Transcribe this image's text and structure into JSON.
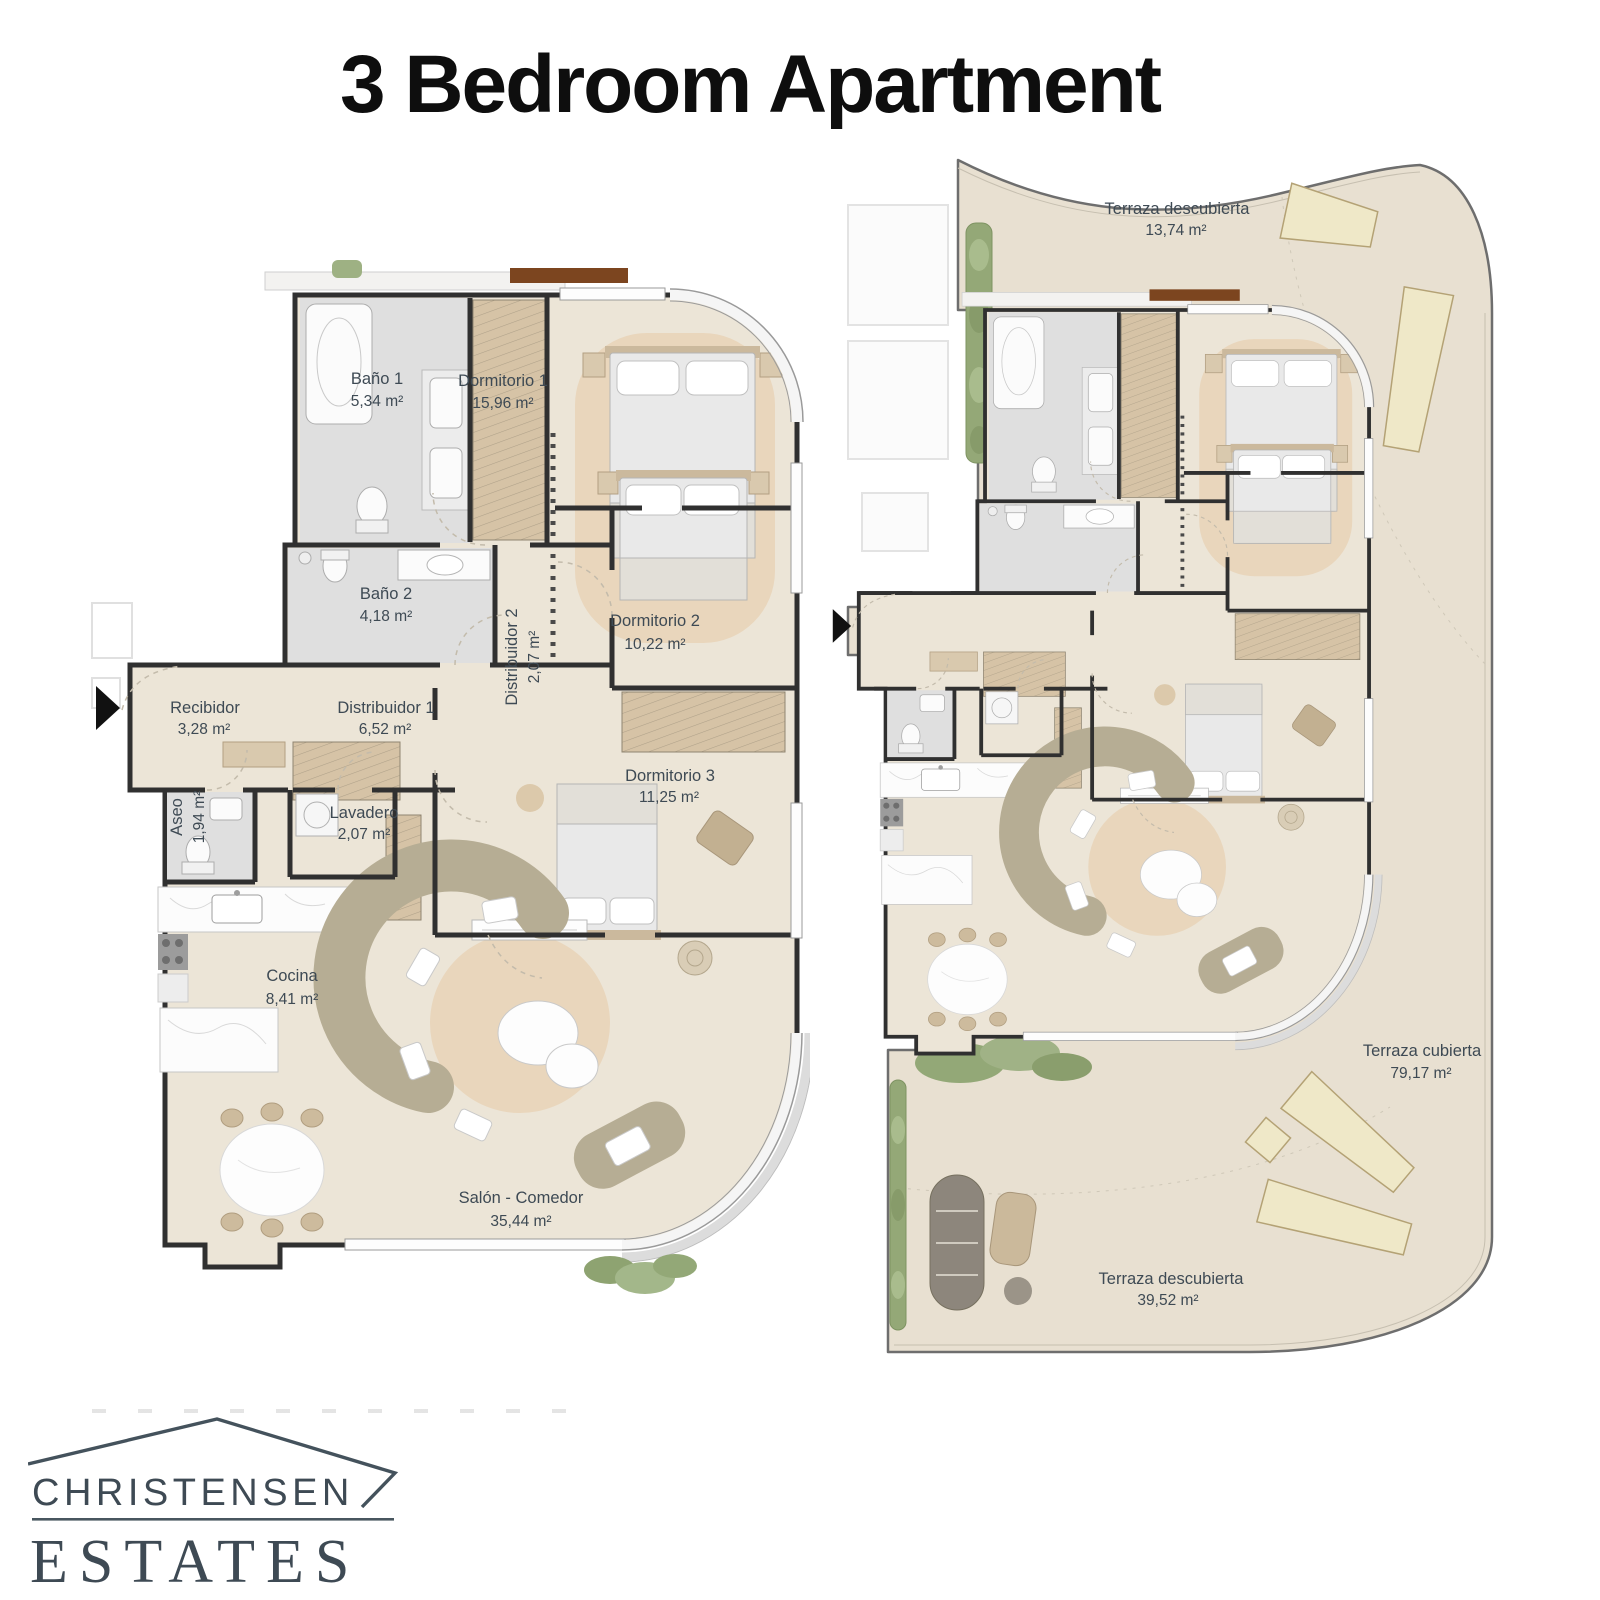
{
  "title": "3 Bedroom Apartment",
  "plans": {
    "left": {
      "name": "Apartment interior plan",
      "rooms": [
        {
          "label": "Baño 1",
          "area": "5,34 m²"
        },
        {
          "label": "Dormitorio 1",
          "area": "15,96 m²"
        },
        {
          "label": "Baño 2",
          "area": "4,18 m²"
        },
        {
          "label": "Distribuidor 2",
          "area": "2,07 m²"
        },
        {
          "label": "Dormitorio 2",
          "area": "10,22 m²"
        },
        {
          "label": "Recibidor",
          "area": "3,28 m²"
        },
        {
          "label": "Distribuidor 1",
          "area": "6,52 m²"
        },
        {
          "label": "Aseo",
          "area": "1,94 m²"
        },
        {
          "label": "Lavadero",
          "area": "2,07 m²"
        },
        {
          "label": "Dormitorio 3",
          "area": "11,25 m²"
        },
        {
          "label": "Cocina",
          "area": "8,41 m²"
        },
        {
          "label": "Salón - Comedor",
          "area": "35,44 m²"
        }
      ]
    },
    "right": {
      "name": "Apartment with terraces plan",
      "rooms": [
        {
          "label": "Terraza descubierta",
          "area": "13,74 m²"
        },
        {
          "label": "Terraza cubierta",
          "area": "79,17 m²"
        },
        {
          "label": "Terraza descubierta",
          "area": "39,52 m²"
        }
      ]
    }
  },
  "logo": {
    "line1": "CHRISTENSEN",
    "line2": "ESTATES"
  },
  "colors": {
    "wall": "#303030",
    "floor_beige": "#ece5d7",
    "terrace_beige": "#e8e0d1",
    "bath_gray": "#dfdfdf",
    "wood_tan": "#d6c3a6",
    "rug": "#e9d6bc",
    "sofa": "#b6ad94",
    "plant_green": "#94a877",
    "lounger": "#efe8c8",
    "label_text": "#3e4a54",
    "logo_dark": "#48565f",
    "logo_light": "#95a3b1",
    "lintel_brown": "#7c451f"
  }
}
